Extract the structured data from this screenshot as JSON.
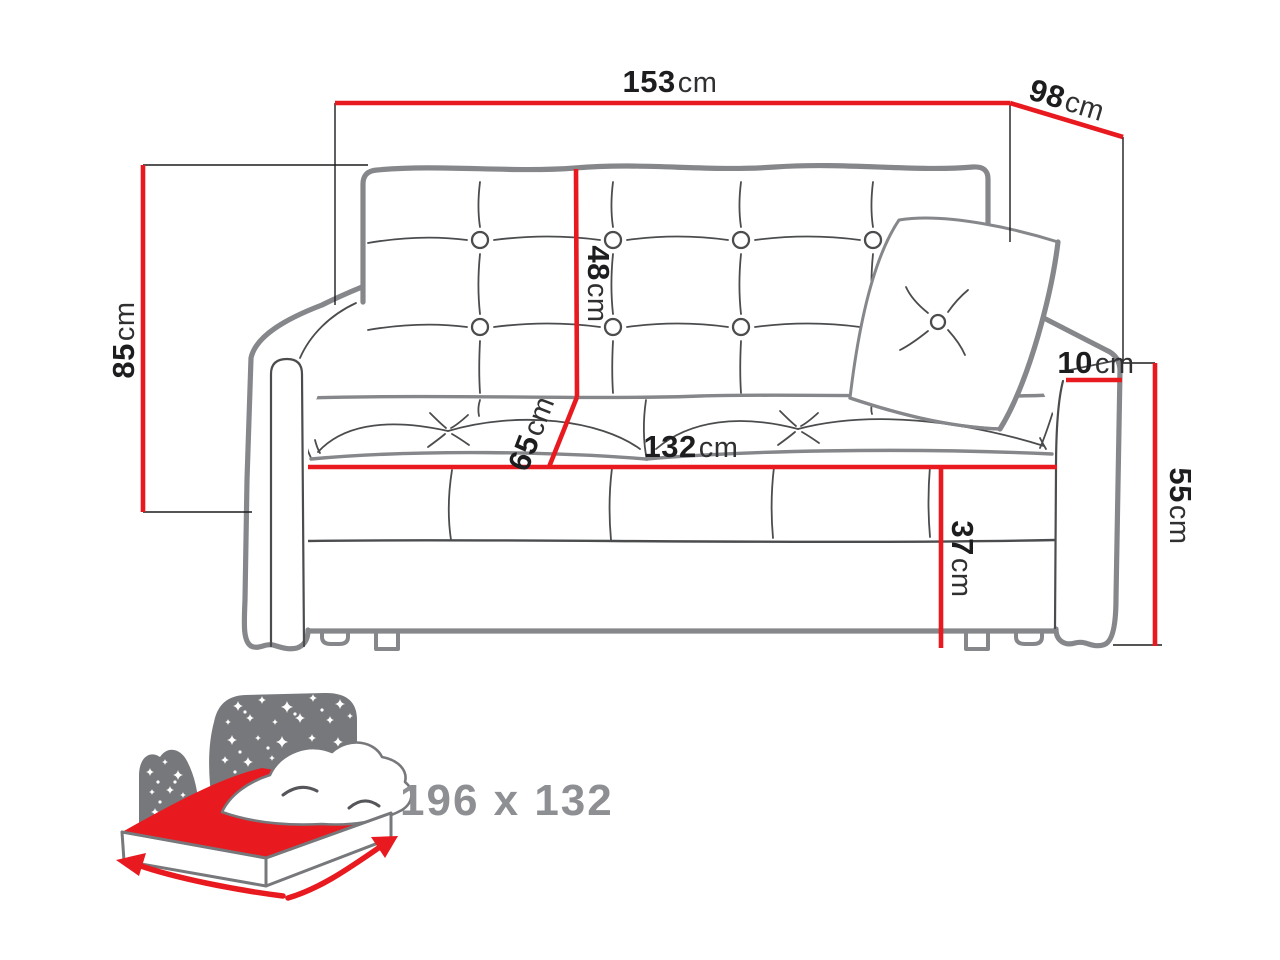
{
  "diagram": {
    "title": "sofa-bed dimension drawing",
    "dimensions": {
      "overall_width": {
        "value": "153",
        "unit": "cm"
      },
      "depth": {
        "value": "98",
        "unit": "cm"
      },
      "overall_height": {
        "value": "85",
        "unit": "cm"
      },
      "backrest_height": {
        "value": "48",
        "unit": "cm"
      },
      "seat_depth": {
        "value": "65",
        "unit": "cm"
      },
      "seat_width": {
        "value": "132",
        "unit": "cm"
      },
      "armrest_width": {
        "value": "10",
        "unit": "cm"
      },
      "armrest_height": {
        "value": "55",
        "unit": "cm"
      },
      "seat_height": {
        "value": "37",
        "unit": "cm"
      }
    },
    "sleeping_area": {
      "size_label": "196 x 132"
    },
    "colors": {
      "dimension_red": "#e8191f",
      "outline_gray": "#85878a",
      "detail_gray": "#4b4c4e",
      "icon_gray": "#77787b",
      "label_gray": "#8d8f92",
      "text_black": "#1d1d1f"
    }
  }
}
